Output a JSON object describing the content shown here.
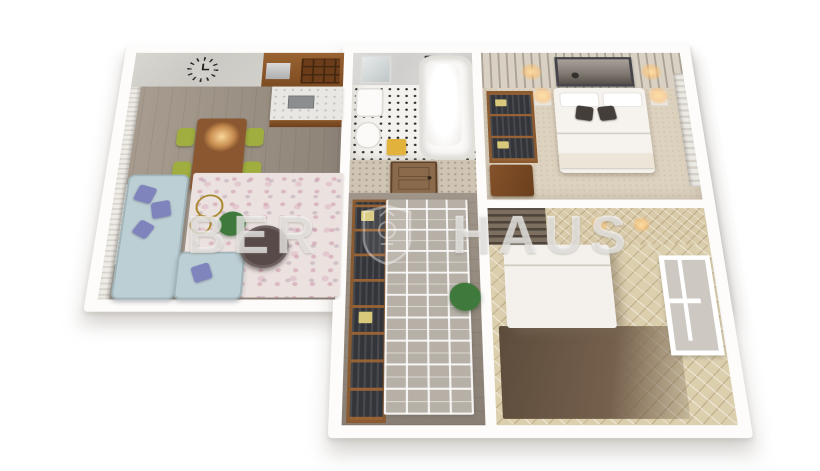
{
  "watermark": {
    "text_left": "BER",
    "text_right": "HAUS",
    "icon": "shield-crest-icon",
    "color": "rgba(255,255,255,0.42)"
  },
  "scene": {
    "type": "3d-floorplan-render",
    "rooms": [
      {
        "id": "living-room",
        "floor": "wood-plank",
        "features": [
          "wall-clock",
          "kitchen-cabinets",
          "wine-rack",
          "kitchen-counter",
          "sink",
          "dining-table",
          "four-green-chairs",
          "pendant-light",
          "window-blinds",
          "radiator",
          "corner-sofa",
          "purple-cushions",
          "floral-rug",
          "coffee-table",
          "potted-plant",
          "gold-ring-decor"
        ]
      },
      {
        "id": "bathroom",
        "floor": "black-white-mosaic",
        "features": [
          "bathtub",
          "shower-fixture",
          "mirror",
          "washbasin",
          "toilet",
          "yellow-towel",
          "marble-wall"
        ]
      },
      {
        "id": "bedroom-main",
        "floor": "beige-carpet",
        "features": [
          "double-bed",
          "white-pillows",
          "dark-pillows",
          "two-nightstands",
          "glowing-lamps",
          "wall-artwork",
          "slat-accent-wall",
          "open-wardrobe",
          "dresser",
          "window-curtains"
        ]
      },
      {
        "id": "hallway",
        "floor": "wood-plank",
        "features": [
          "interior-door",
          "open-wardrobe-shelves",
          "geometric-rug",
          "potted-plant",
          "patterned-wallpaper"
        ]
      },
      {
        "id": "bedroom-second",
        "floor": "diamond-pattern",
        "features": [
          "white-bed",
          "dark-rug",
          "tall-window",
          "slat-accent-wall",
          "ceiling-lights"
        ]
      }
    ]
  },
  "colors": {
    "sofa": "#bccfd4",
    "cushion": "#7f84bd",
    "chair": "#9fae3e",
    "diningTable": "#8a5730",
    "coffeeTable": "#584a49",
    "towel": "#e2b33c",
    "plant": "#3f7a3c",
    "door": "#8a6a4a",
    "woodCabinet": "#8a5a30",
    "darkPillow": "#433e3a",
    "glow": "#ffc57a"
  }
}
